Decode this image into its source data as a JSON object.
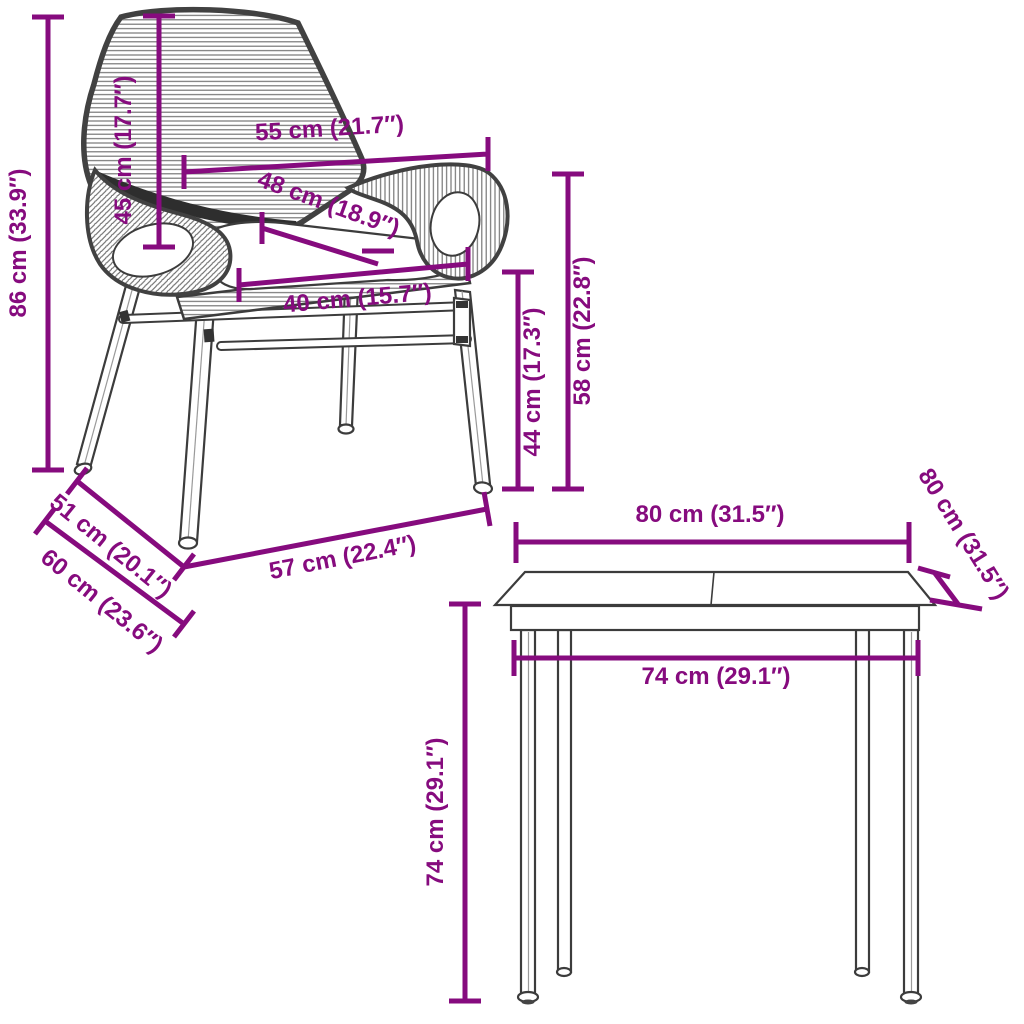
{
  "diagram": {
    "background_color": "#FFFFFF",
    "dimension_color": "#860B7E",
    "drawing_color": "#3C3C3C"
  },
  "chair": {
    "dims": {
      "total_height": "86 cm (33.9″)",
      "backrest_height": "45 cm (17.7″)",
      "top_width": "55 cm (21.7″)",
      "seat_depth": "48 cm (18.9″)",
      "seat_width": "40 cm (15.7″)",
      "seat_height": "44 cm (17.3″)",
      "armrest_height": "58 cm (22.8″)",
      "upper_depth": "51 cm (20.1″)",
      "lower_depth": "60 cm (23.6″)",
      "base_width": "57 cm (22.4″)"
    }
  },
  "table": {
    "dims": {
      "top_width": "80 cm (31.5″)",
      "top_depth": "80 cm (31.5″)",
      "frame_width": "74 cm (29.1″)",
      "height": "74 cm (29.1″)"
    }
  }
}
